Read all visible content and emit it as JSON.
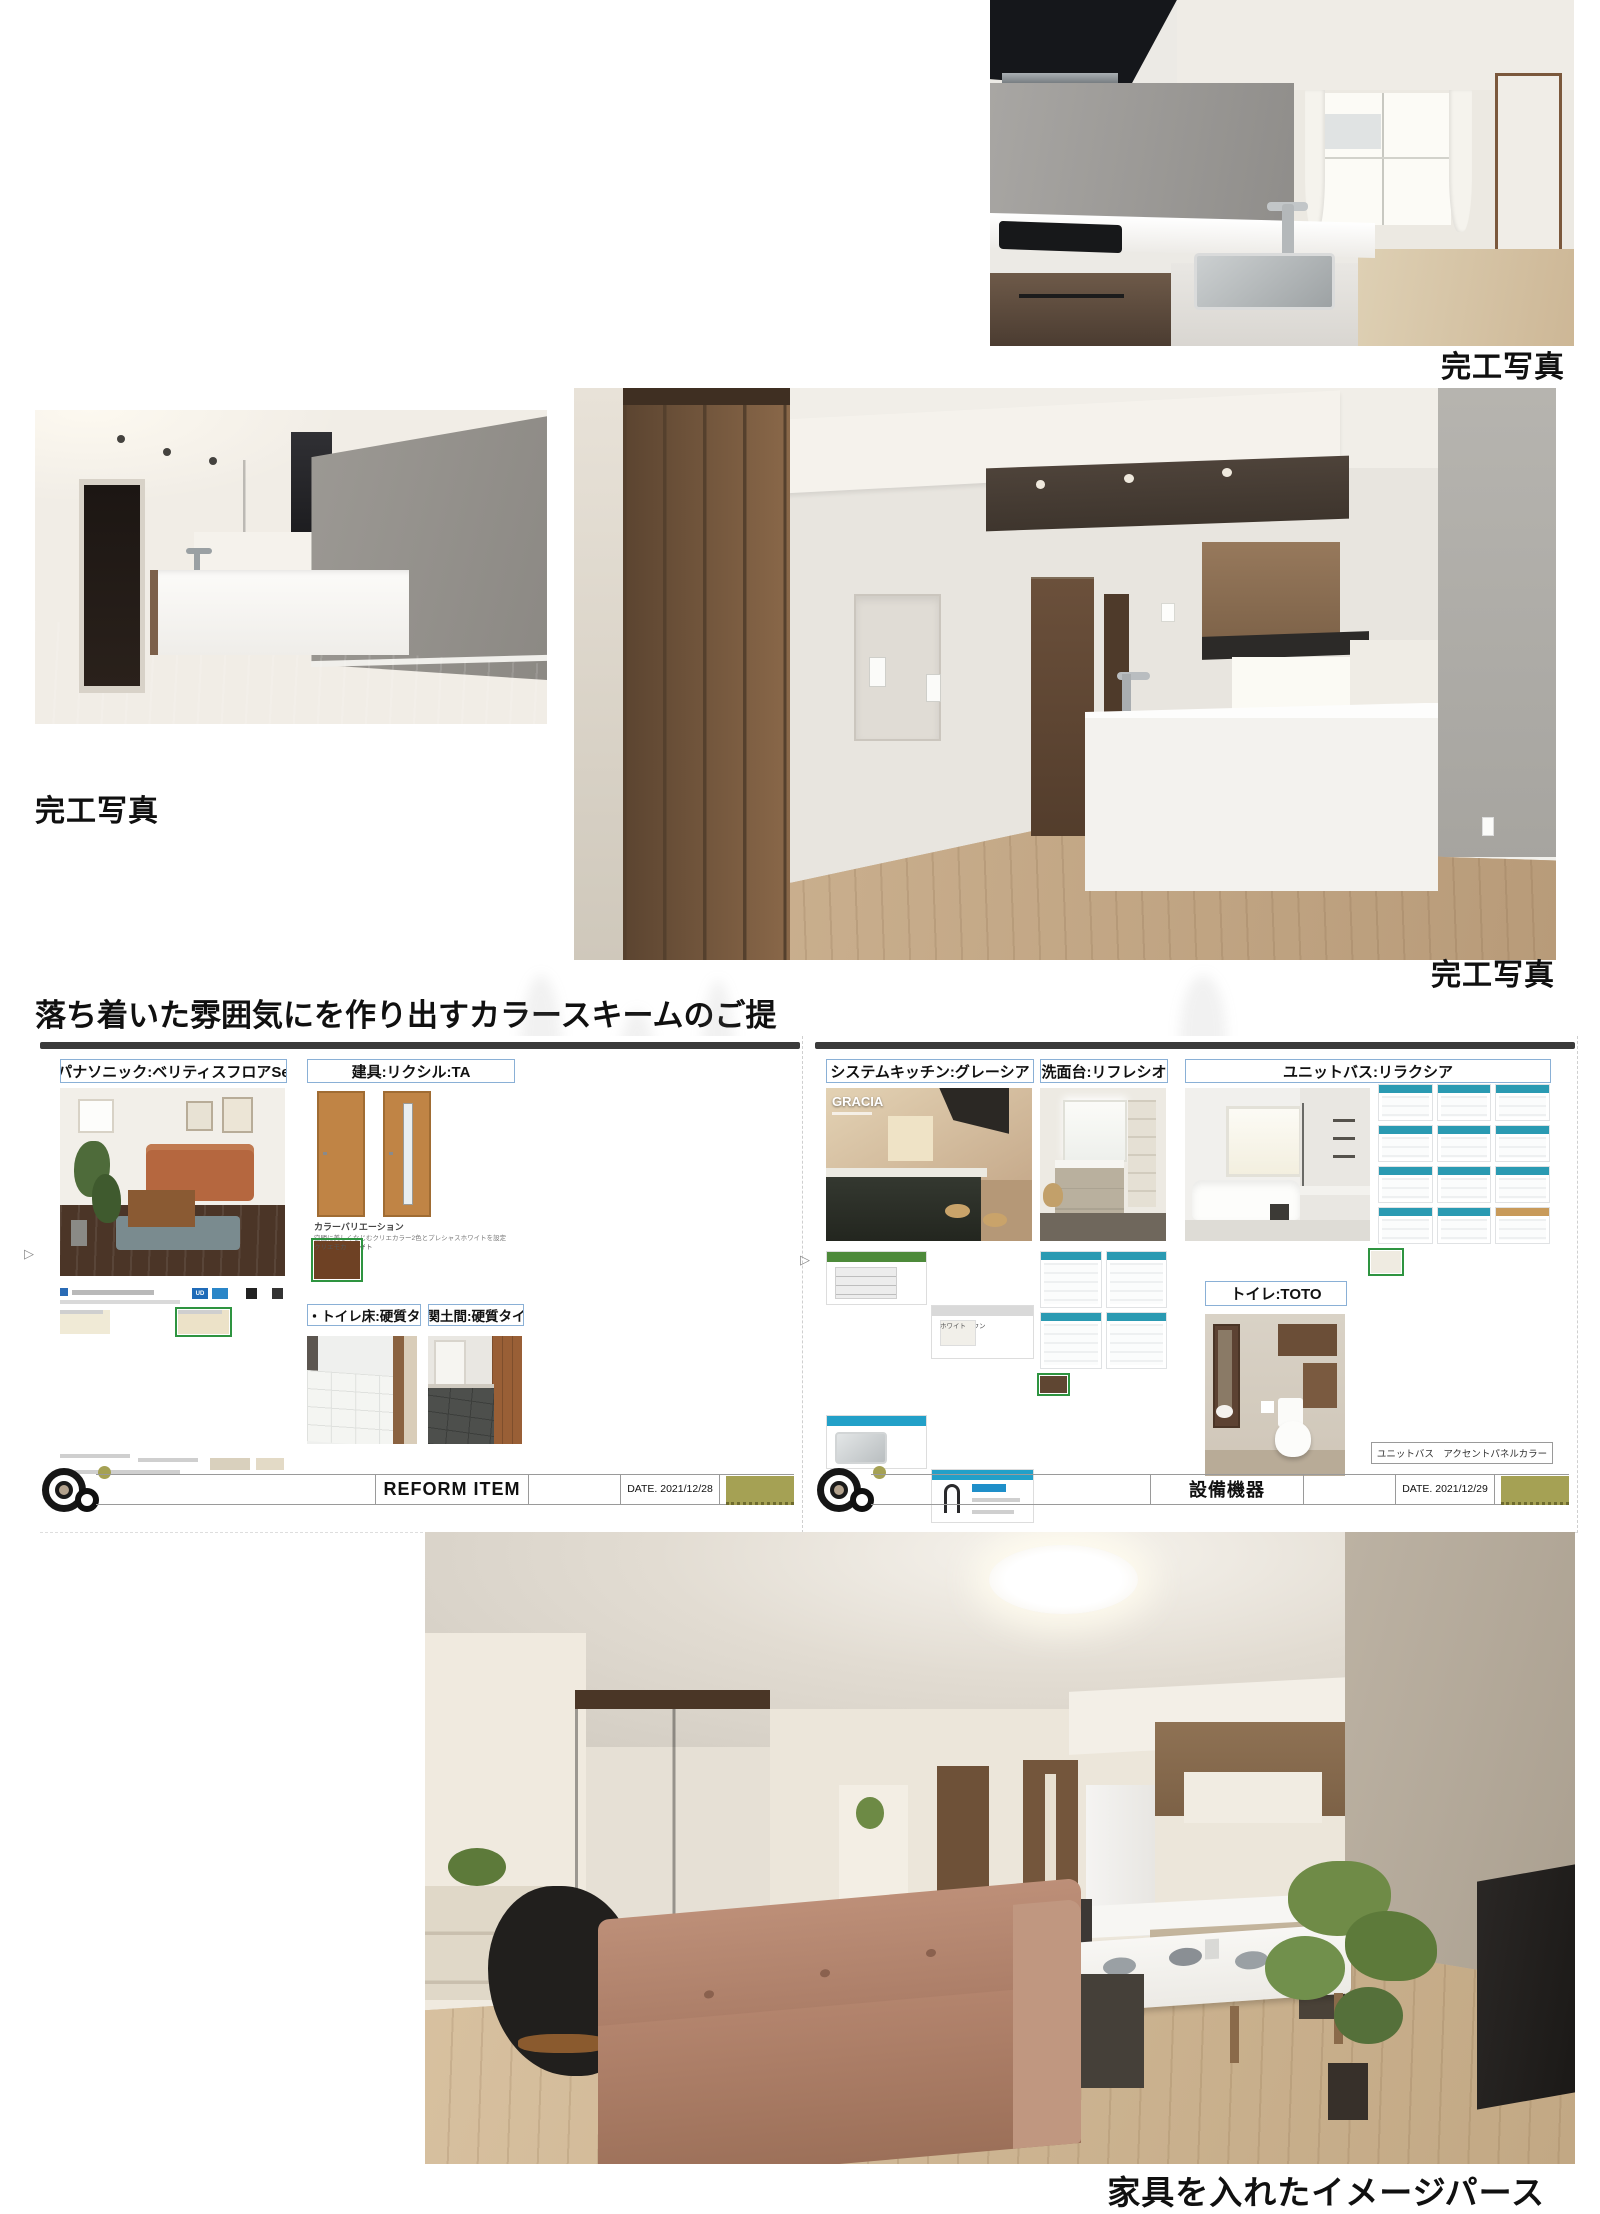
{
  "captions": {
    "photo_top": "完工写真",
    "photo_left": "完工写真",
    "photo_large": "完工写真",
    "render": "家具を入れたイメージパース"
  },
  "heading": "落ち着いた雰囲気にを作り出すカラースキームのご提",
  "sheet_left": {
    "labels": {
      "flooring": "パナソニック:ベリティスフロアSe",
      "doors": "建具:リクシル:TA",
      "washroom_floor": "洗面・トイレ床:硬質タイル",
      "entrance_floor": "玄関土間:硬質タイル"
    },
    "color_variation": {
      "title": "カラーバリエーション",
      "caption": "空間に美しくなじむクリエカラー2色とプレシャスホワイトを設定",
      "swatches": [
        {
          "c": "#f4f2ec",
          "n": "プレシャスホワイト"
        },
        {
          "c": "#eae4d3",
          "n": "クリエアイボリー"
        },
        {
          "c": "#c0884a",
          "n": "クリエラスク"
        },
        {
          "c": "#6e4124",
          "n": "クリエモカ",
          "h": true
        }
      ]
    },
    "catalog": {
      "badge": "UD",
      "swatches_a": [
        {
          "c": "#33261d"
        },
        {
          "c": "#84462e"
        },
        {
          "c": "#c99f66"
        },
        {
          "c": "#dcc9a2"
        },
        {
          "c": "#ece3cb"
        },
        {
          "c": "#f0ead6"
        }
      ],
      "swatches_b": [
        {
          "c": "#241c17"
        },
        {
          "c": "#6d3526"
        },
        {
          "c": "#4f6b80"
        },
        {
          "c": "#c79e6b"
        },
        {
          "c": "#d9ba84",
          "h": true
        },
        {
          "c": "#e3cf9e"
        },
        {
          "c": "#f2ecd8"
        },
        {
          "c": "#ece2c8"
        }
      ]
    },
    "footer": {
      "title": "REFORM  ITEM",
      "date": "DATE. 2021/12/28"
    }
  },
  "sheet_right": {
    "labels": {
      "kitchen": "システムキッチン:グレーシア",
      "vanity": "洗面台:リフレシオ",
      "bath": "ユニットバス:リラクシア",
      "toilet": "トイレ:TOTO"
    },
    "kitchen_brand": "GRACIA",
    "panels": {
      "range_hood": "レンジフード",
      "hood_type": "VUAタイプ",
      "rail_handle": "レール引手"
    },
    "cabinet_colors": [
      {
        "c": "#3c2e25",
        "n": "ダークブラウン"
      },
      {
        "c": "#f1efe9",
        "n": "ホワイト"
      }
    ],
    "stove_chips": [
      {
        "c": "#1d1d1f"
      },
      {
        "c": "#3a3f45"
      },
      {
        "c": "#8a8f94"
      },
      {
        "c": "#2a2c30"
      },
      {
        "c": "#caccce"
      }
    ],
    "vanity_swatches": [
      {
        "c": "#efe9da"
      },
      {
        "c": "#f4f0e7"
      },
      {
        "c": "#a8a8a6"
      },
      {
        "c": "#7c3a30"
      },
      {
        "c": "#cba671"
      },
      {
        "c": "#7b5136",
        "h": true
      },
      {
        "c": "#4a3426"
      },
      {
        "c": "#d9c7a8"
      },
      {
        "c": "#e9e4d9"
      },
      {
        "c": "#bab6af"
      },
      {
        "c": "#8d8274"
      },
      {
        "c": "#3d3a36"
      },
      {
        "c": "#f0e8d3"
      },
      {
        "c": "#dabf97"
      },
      {
        "c": "#a5815c"
      },
      {
        "c": "#5f4632"
      }
    ],
    "accent_swatches": [
      {
        "c": "#7fb3c9"
      },
      {
        "c": "#eef0ef"
      },
      {
        "c": "#e7e0d0"
      },
      {
        "c": "#d9d2c3"
      },
      {
        "c": "#f2efe8"
      },
      {
        "c": "#cfd8db"
      },
      {
        "c": "#f4f2ee"
      },
      {
        "c": "#e2d8c6"
      },
      {
        "c": "#8a8d90"
      },
      {
        "c": "#ece9e1"
      },
      {
        "c": "#b0bec5"
      },
      {
        "c": "#efeae0"
      },
      {
        "c": "#c9b899"
      },
      {
        "c": "#6e5a45"
      },
      {
        "c": "#f1ede4"
      },
      {
        "c": "#9fb8c4"
      },
      {
        "c": "#e8e4da"
      },
      {
        "c": "#d9c9a8",
        "h": true
      },
      {
        "c": "#efece4"
      },
      {
        "c": "#4a4440"
      },
      {
        "c": "#cdd6da"
      },
      {
        "c": "#efeae2"
      },
      {
        "c": "#8a6f52"
      },
      {
        "c": "#3a342e"
      },
      {
        "c": "#e9e5dc"
      },
      {
        "c": "#e3dfd6"
      },
      {
        "c": "#d8d2c8"
      },
      {
        "c": "#6e665c"
      },
      {
        "c": "#2e2a26"
      },
      {
        "c": "#efebe1"
      }
    ],
    "accent_label": "ユニットバス　アクセントパネルカラー",
    "footer": {
      "title": "設備機器",
      "date": "DATE. 2021/12/29"
    }
  },
  "colors": {
    "accent_green": "#2e9440",
    "label_border": "#8ab0d6",
    "olive": "#a5a154",
    "topbar": "#3a3a3a",
    "cell_header": "#2a9ab2"
  }
}
